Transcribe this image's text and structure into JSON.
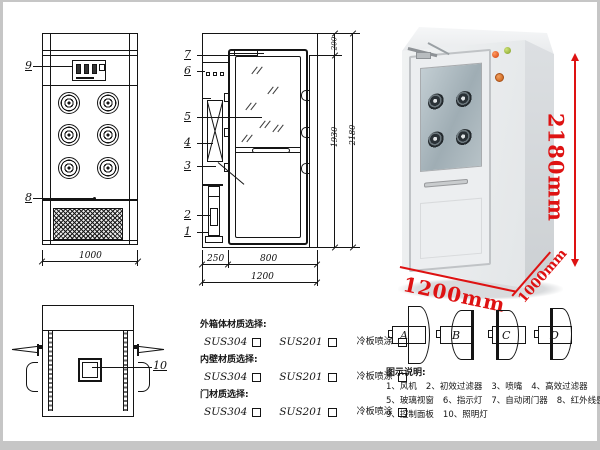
{
  "colors": {
    "line": "#141414",
    "dim_red": "#de1212",
    "frame_grey": "#c6c6c6",
    "cabinet_body": "#eceef0"
  },
  "front_view": {
    "callout_9": "9",
    "callout_8": "8",
    "dim_width": "1000"
  },
  "side_view": {
    "callouts": [
      "7",
      "6",
      "5",
      "4",
      "3",
      "2",
      "1"
    ],
    "dim_left": "250",
    "dim_door": "800",
    "dim_total": "1200",
    "dim_top": "200",
    "dim_inner_height": "1930",
    "dim_height": "2180"
  },
  "photo": {
    "dim_height": "2180mm",
    "dim_width": "1200mm",
    "dim_depth": "1000mm"
  },
  "top_view": {
    "callout_10": "10"
  },
  "materials": {
    "groups": [
      {
        "title": "外箱体材质选择:",
        "options": [
          "SUS304",
          "SUS201",
          "冷板喷涂"
        ]
      },
      {
        "title": "内壁材质选择:",
        "options": [
          "SUS304",
          "SUS201",
          "冷板喷涂"
        ]
      },
      {
        "title": "门材质选择:",
        "options": [
          "SUS304",
          "SUS201",
          "冷板喷涂"
        ]
      }
    ]
  },
  "door_options": {
    "labels": [
      "A",
      "B",
      "C",
      "D"
    ]
  },
  "legend": {
    "title": "图示说明:",
    "items": [
      "1、风机",
      "2、初效过滤器",
      "3、喷嘴",
      "4、高效过滤器",
      "5、玻璃视窗",
      "6、指示灯",
      "7、自动闭门器",
      "8、红外线感应器",
      "9、控制面板",
      "10、照明灯"
    ]
  }
}
